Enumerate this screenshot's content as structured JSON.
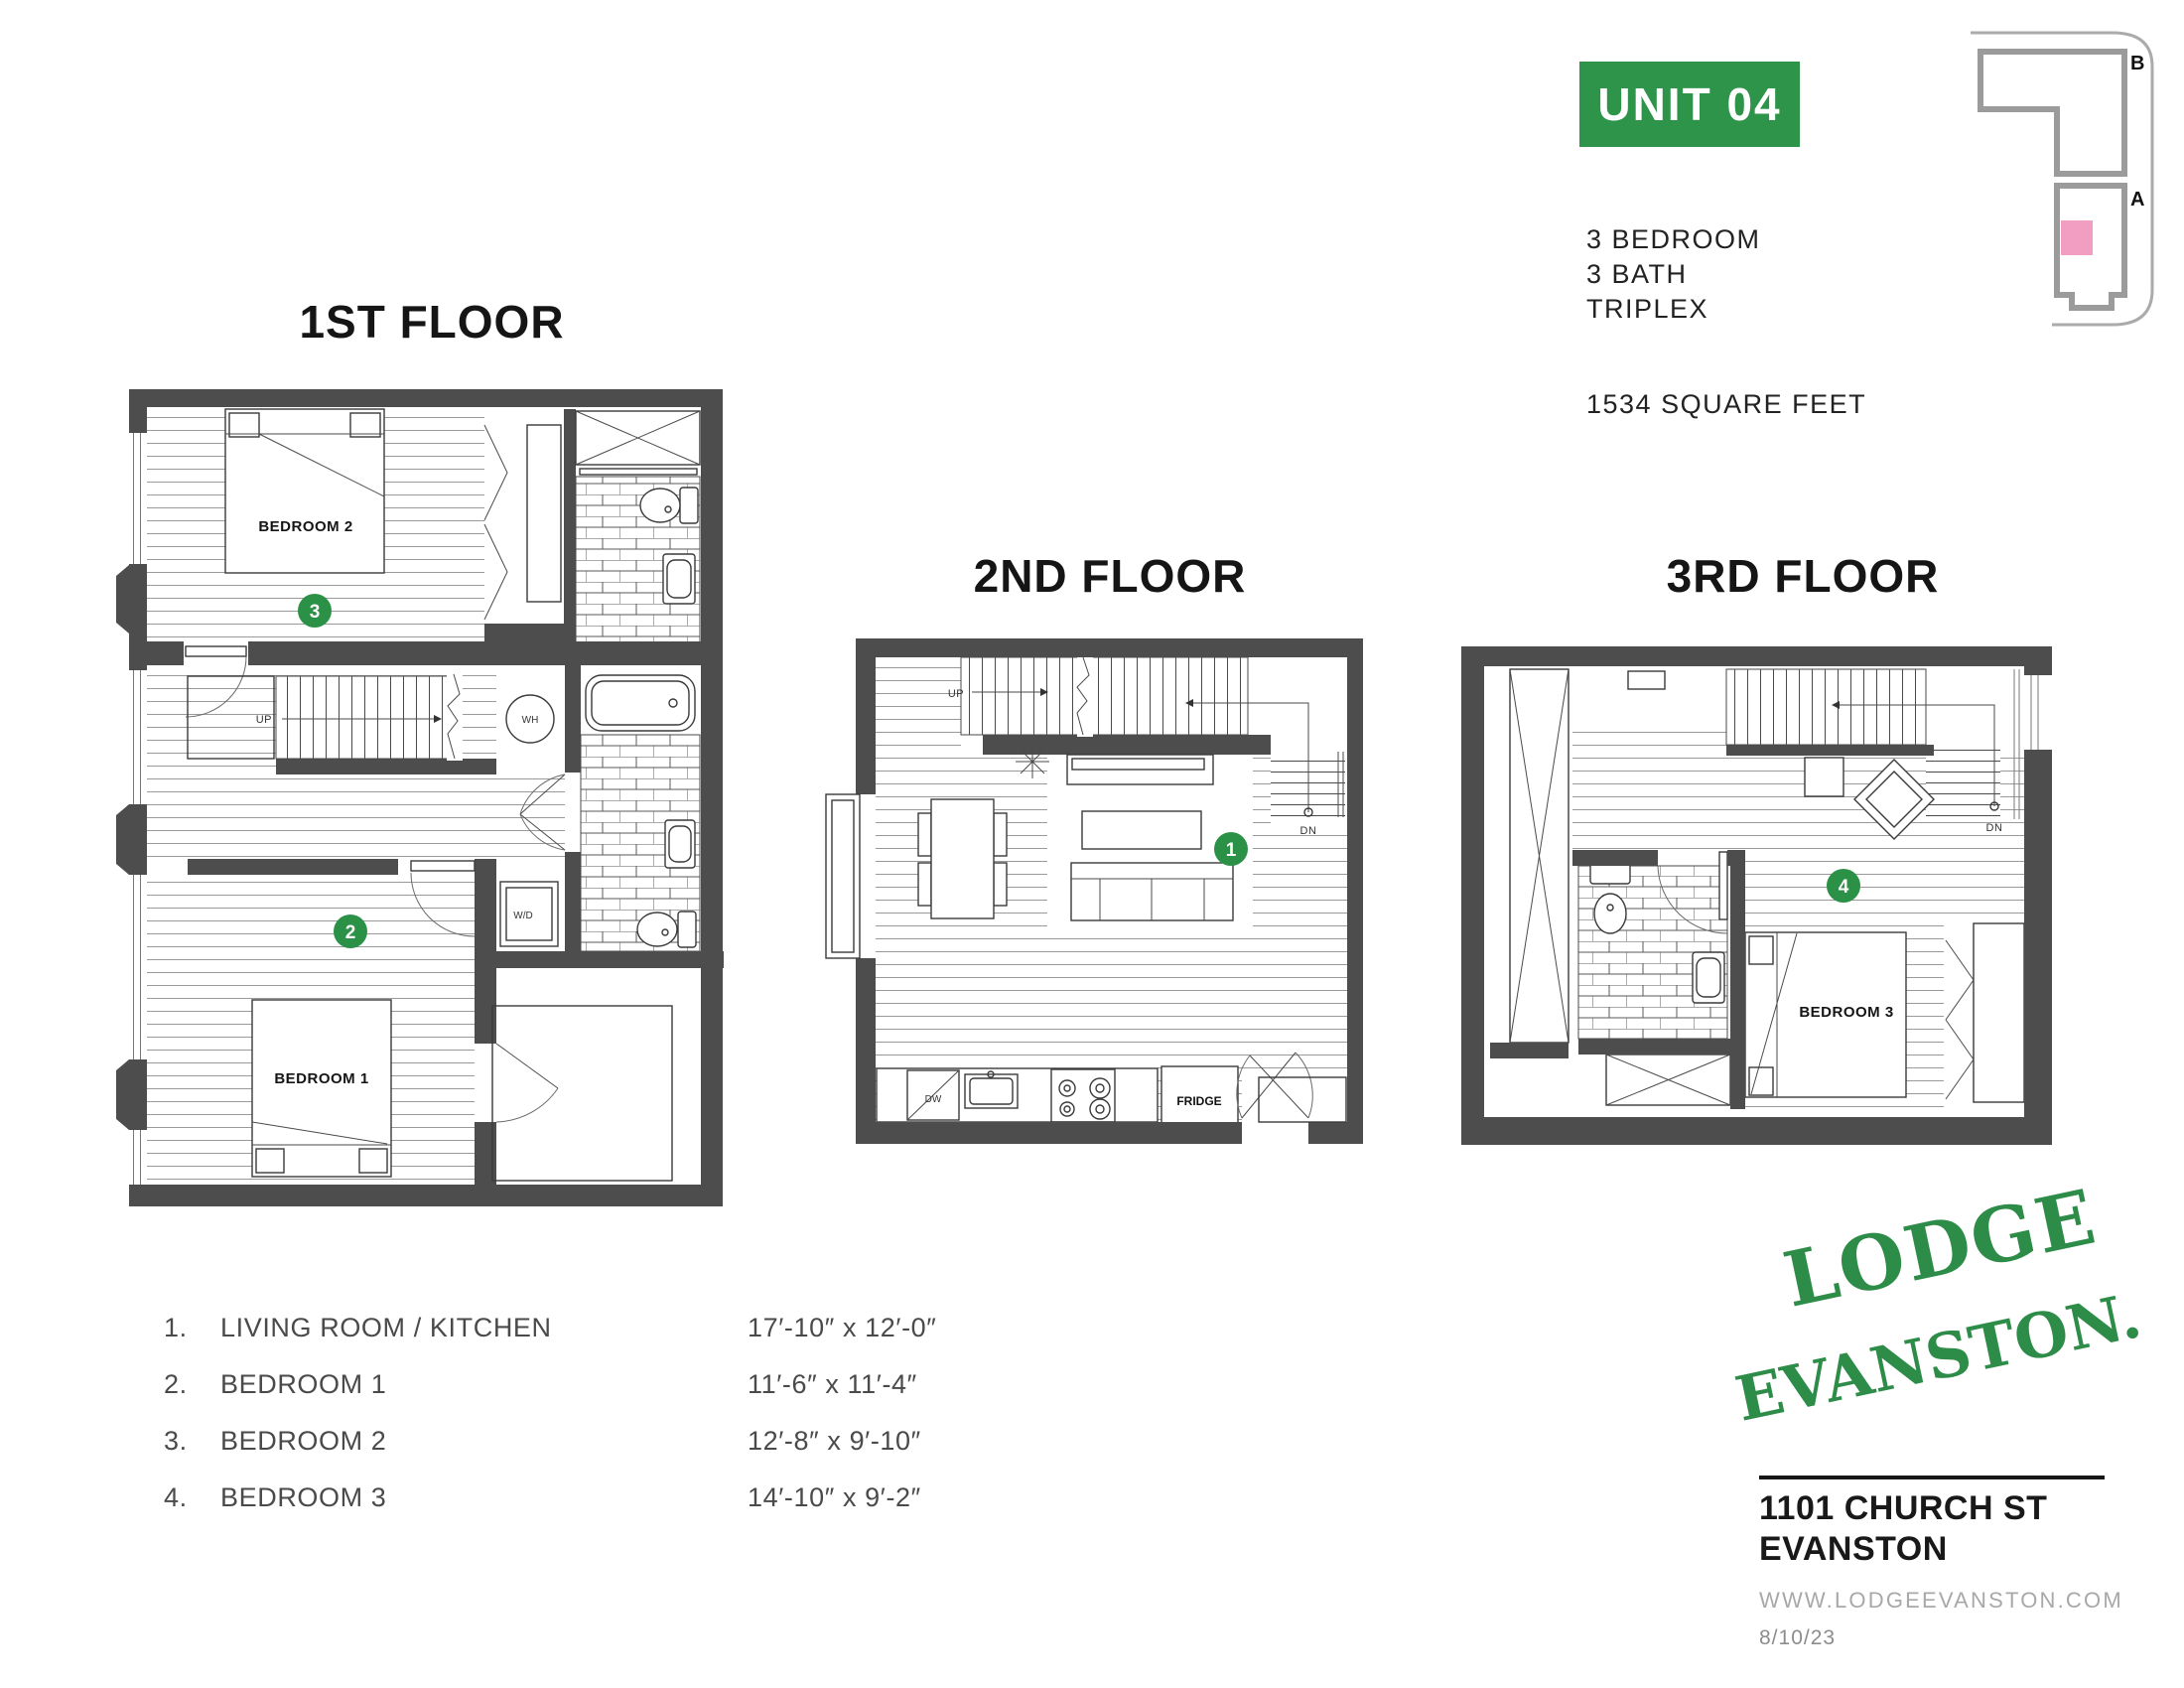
{
  "colors": {
    "accent_green": "#2E9449",
    "circle_green": "#2B9147",
    "logo_green": "#2E8C49",
    "wall_gray": "#4D4D4D",
    "keymap_gray": "#9B9B9B",
    "highlight_pink": "#F19EC2",
    "text_light": "#A8A8A8"
  },
  "unit": {
    "badge": "UNIT 04",
    "lines": [
      "3 BEDROOM",
      "3 BATH",
      "TRIPLEX"
    ],
    "area": "1534 SQUARE FEET"
  },
  "key_map": {
    "label_b": "B",
    "label_a": "A"
  },
  "floors": [
    {
      "title": "1ST FLOOR",
      "rooms": {
        "bedroom2": "BEDROOM 2",
        "bedroom1": "BEDROOM 1"
      },
      "markers": {
        "bedroom2": "3",
        "bedroom1": "2"
      },
      "labels": {
        "up": "UP",
        "wh": "WH",
        "wd": "W/D"
      }
    },
    {
      "title": "2ND FLOOR",
      "markers": {
        "living": "1"
      },
      "labels": {
        "up": "UP",
        "dn": "DN",
        "dw": "DW",
        "fridge": "FRIDGE"
      }
    },
    {
      "title": "3RD FLOOR",
      "rooms": {
        "bedroom3": "BEDROOM 3"
      },
      "markers": {
        "bedroom3": "4"
      },
      "labels": {
        "dn": "DN"
      }
    }
  ],
  "legend": {
    "items": [
      {
        "num": "1.",
        "label": "LIVING ROOM / KITCHEN",
        "dims": "17′-10″ x 12′-0″"
      },
      {
        "num": "2.",
        "label": "BEDROOM 1",
        "dims": "11′-6″ x 11′-4″"
      },
      {
        "num": "3.",
        "label": "BEDROOM 2",
        "dims": "12′-8″ x 9′-10″"
      },
      {
        "num": "4.",
        "label": "BEDROOM 3",
        "dims": "14′-10″ x 9′-2″"
      }
    ]
  },
  "brand": {
    "logo_line1": "LODGE",
    "logo_line2": "EVANSTON.",
    "address_line1": "1101 CHURCH ST",
    "address_line2": "EVANSTON",
    "website": "WWW.LODGEEVANSTON.COM",
    "date": "8/10/23"
  }
}
